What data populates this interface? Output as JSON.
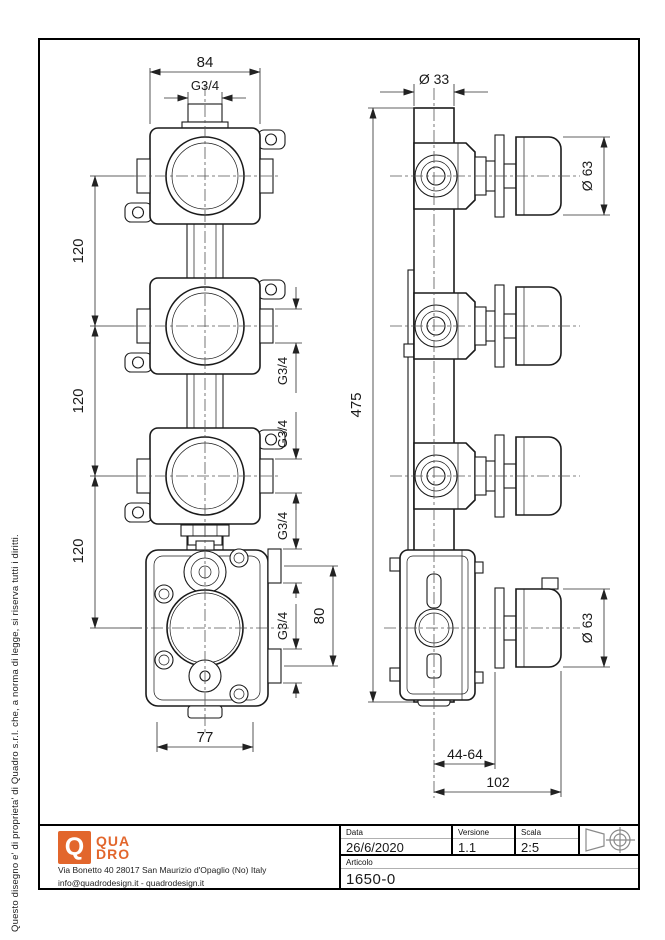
{
  "page": {
    "background": "#ffffff",
    "line_color": "#1a1a1a",
    "accent_color": "#e2662c"
  },
  "side_note": "Questo disegno e' di proprieta' di Quadro s.r.l. che, a norma di legge, si riserva tutti i diritti.",
  "front_view": {
    "dim_width_top": "84",
    "dim_thread_top": "G3/4",
    "dim_spacing": [
      "120",
      "120",
      "120"
    ],
    "dim_ports": [
      "G3/4",
      "G3/4",
      "G3/4",
      "G3/4"
    ],
    "dim_port_spacing": "80",
    "dim_width_bottom": "77"
  },
  "side_view": {
    "dim_body_dia": "Ø 33",
    "dim_height": "475",
    "dim_knob_dia_top": "Ø 63",
    "dim_knob_dia_bottom": "Ø 63",
    "dim_depth_range": "44-64",
    "dim_total_depth": "102"
  },
  "footer": {
    "logo": {
      "letter": "Q",
      "line1": "QUA",
      "line2": "DRO",
      "color": "#e2662c"
    },
    "address_line1": "Via Bonetto 40  28017 San Maurizio d'Opaglio (No) Italy",
    "address_line2": "info@quadrodesign.it  -  quadrodesign.it",
    "title_block": {
      "date_label": "Data",
      "date_value": "26/6/2020",
      "version_label": "Versione",
      "version_value": "1.1",
      "scale_label": "Scala",
      "scale_value": "2:5",
      "article_label": "Articolo",
      "article_value": "1650-0"
    }
  }
}
